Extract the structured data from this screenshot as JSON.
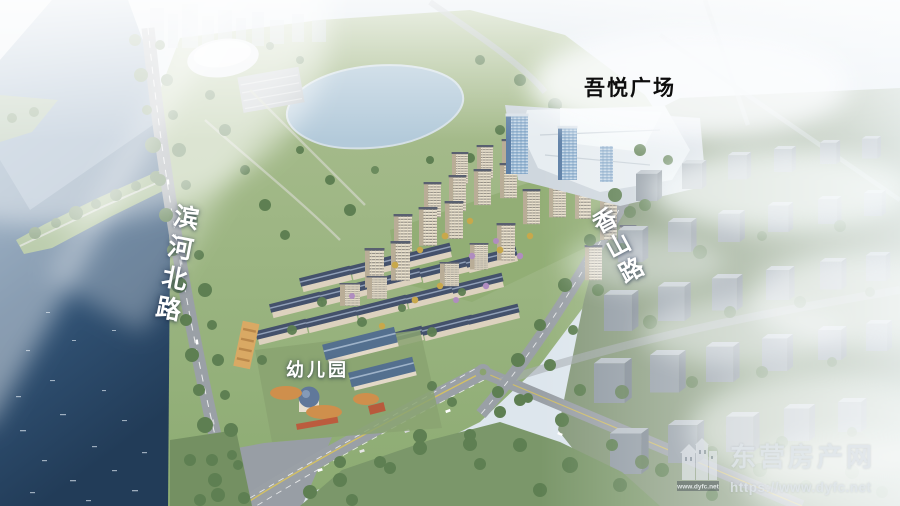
{
  "labels": {
    "mall": "吾悦广场",
    "road_left": "滨河北路",
    "road_right": "香山路",
    "kindergarten": "幼儿园"
  },
  "watermark": {
    "site_name": "东营房产网",
    "site_url": "https://www.dyfc.net",
    "logo_caption": "www.dyfc.net"
  },
  "colors": {
    "label_white": "#ffffff",
    "label_black": "#0d0d0d",
    "watermark_text": "#dfe5ea",
    "water_deep": "#24405f",
    "water_light": "#8aa6c0",
    "park_green": "#9fb681",
    "tree_green": "#5e7f52",
    "building_cream": "#e9e0cc",
    "roof_slate": "#44516b",
    "kindergarten_roof_blue": "#54708f",
    "mall_glass_blue": "#8fb0cf",
    "playground_orange": "#cf8f4c",
    "road_gray": "#9aa0a6"
  }
}
